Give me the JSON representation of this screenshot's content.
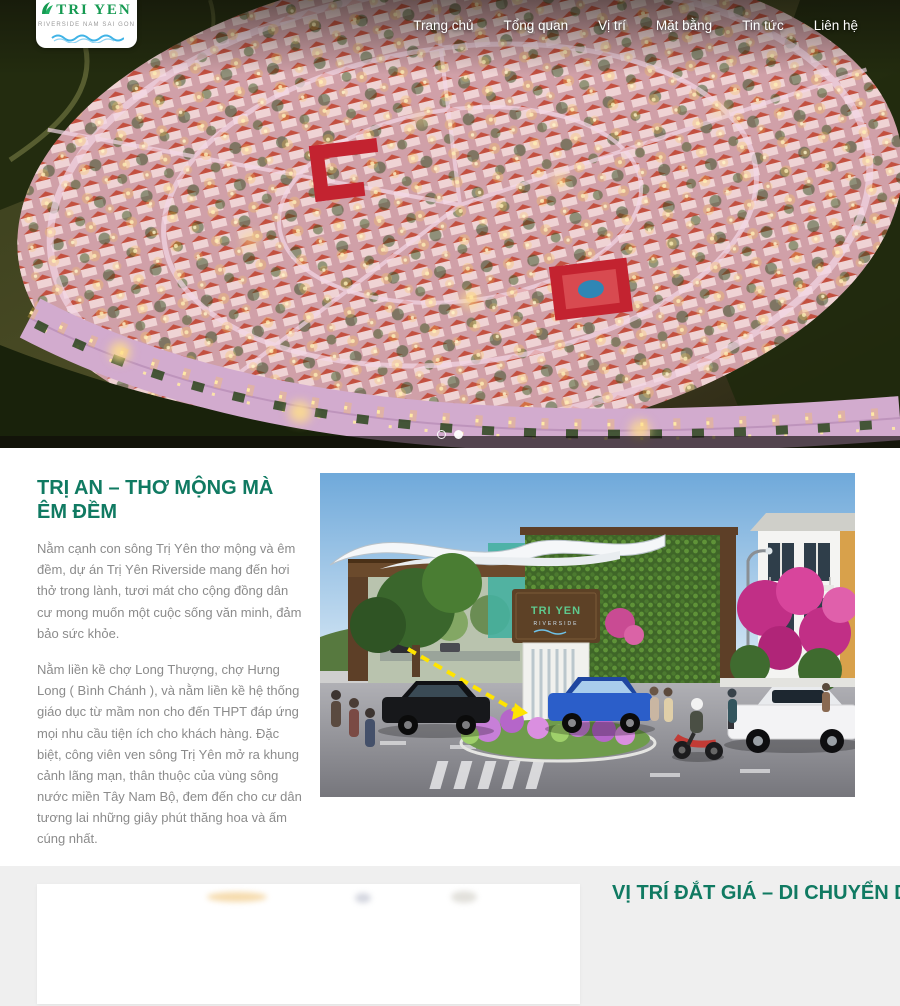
{
  "brand": {
    "name": "TRI YEN",
    "tagline": "RIVERSIDE NAM SAI GON"
  },
  "nav": {
    "items": [
      {
        "label": "Trang chủ"
      },
      {
        "label": "Tổng quan"
      },
      {
        "label": "Vị trí"
      },
      {
        "label": "Mặt bằng"
      },
      {
        "label": "Tin tức"
      },
      {
        "label": "Liên hệ"
      }
    ]
  },
  "hero": {
    "dots_total": 2,
    "active_dot_index": 1
  },
  "about": {
    "title": "TRỊ AN – THƠ MỘNG MÀ ÊM ĐỀM",
    "paragraphs": [
      "Nằm cạnh con sông Trị Yên thơ mộng và êm đềm, dự án Trị Yên Riverside mang đến hơi thở trong lành, tươi mát cho cộng đồng dân cư mong muốn một cuộc sống văn minh, đảm bảo sức khỏe.",
      "Nằm liền kề chợ Long Thượng, chợ Hưng Long ( Bình Chánh ), và nằm liền kề hệ thống giáo dục từ mầm non cho đến THPT đáp ứng mọi nhu cầu tiện ích cho khách hàng. Đặc biệt, công viên ven sông Trị Yên mở ra khung cảnh lãng mạn, thân thuộc của vùng sông nước miền Tây Nam Bộ, đem đến cho cư dân tương lai những giây phút thăng hoa và ấm cúng nhất."
    ],
    "stats": [
      {
        "icon": "building-outline-icon",
        "label": "QUY MÔ",
        "value": "~41.000 m2"
      },
      {
        "icon": "house-outline-icon",
        "label": "KHU A",
        "value": "88 CĂN"
      },
      {
        "icon": "warehouse-outline-icon",
        "label": "KHU B",
        "value": "134 CĂN"
      }
    ],
    "photo": {
      "sign_line1": "TRI YEN",
      "sign_line2": "RIVERSIDE"
    }
  },
  "location_section": {
    "title": "VỊ TRÍ ĐẮT GIÁ – DI CHUYỂN DỄ"
  },
  "colors": {
    "brand_green": "#169a52",
    "heading_green": "#107a62",
    "accent_red": "#ee2140",
    "logo_wave_blue": "#3fb3e6",
    "body_text_gray": "#8b8b8b",
    "section2_background": "#efefef"
  }
}
